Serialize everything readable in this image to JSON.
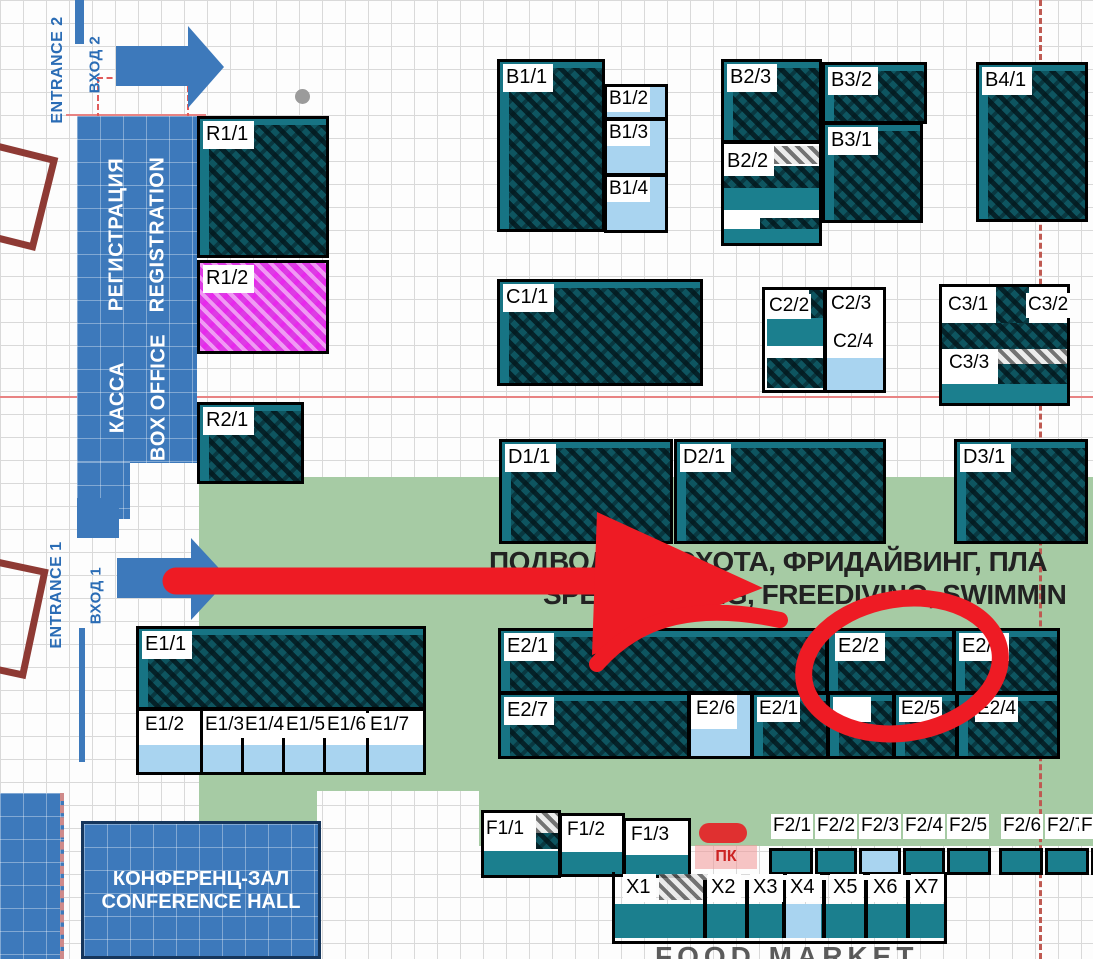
{
  "map": {
    "entrance2": {
      "en": "ENTRANCE 2",
      "ru": "ВХОД 2"
    },
    "entrance1": {
      "en": "ENTRANCE 1",
      "ru": "ВХОД 1"
    },
    "registration": {
      "ru": "РЕГИСТРАЦИЯ",
      "en": "REGISTRATION"
    },
    "box_office": {
      "ru": "КАССА",
      "en": "BOX OFFICE"
    },
    "conference": {
      "ru": "КОНФЕРЕНЦ-ЗАЛ",
      "en": "CONFERENCE HALL"
    },
    "zone_banner": {
      "ru": "ПОДВОДНАЯ ОХОТА, ФРИДАЙВИНГ, ПЛА",
      "en": "SPEARFISHING, FREEDIVING, SWIMMIN"
    },
    "food_market": "FOOD MARKET",
    "pk": "ПК"
  },
  "booths": {
    "r1_1": "R1/1",
    "r1_2": "R1/2",
    "r2_1": "R2/1",
    "b1_1": "B1/1",
    "b1_2": "B1/2",
    "b1_3": "B1/3",
    "b1_4": "B1/4",
    "b2_3": "B2/3",
    "b2_2": "B2/2",
    "b3_2": "B3/2",
    "b3_1": "B3/1",
    "b4_1": "B4/1",
    "c1_1": "C1/1",
    "c2_2": "C2/2",
    "c2_3": "C2/3",
    "c2_4": "C2/4",
    "c3_1": "C3/1",
    "c3_2": "C3/2",
    "c3_3": "C3/3",
    "d1_1": "D1/1",
    "d2_1": "D2/1",
    "d3_1": "D3/1",
    "e1_1": "E1/1",
    "e1_2": "E1/2",
    "e1_3": "E1/3",
    "e1_4": "E1/4",
    "e1_5": "E1/5",
    "e1_6": "E1/6",
    "e1_7": "E1/7",
    "e2_1t": "E2/1",
    "e2_2": "E2/2",
    "e2_3": "E2/3",
    "e2_7": "E2/7",
    "e2_6": "E2/6",
    "e2_1b": "E2/1",
    "e2_hidden": "",
    "e2_5": "E2/5",
    "e2_4": "E2/4",
    "f1_1": "F1/1",
    "f1_2": "F1/2",
    "f1_3": "F1/3",
    "f2_1": "F2/1",
    "f2_2": "F2/2",
    "f2_3": "F2/3",
    "f2_4": "F2/4",
    "f2_5": "F2/5",
    "f2_6": "F2/6",
    "f2_7": "F2/7",
    "f2_8": "F2/8",
    "x1": "X1",
    "x2": "X2",
    "x3": "X3",
    "x4": "X4",
    "x5": "X5",
    "x6": "X6",
    "x7": "X7"
  },
  "colors": {
    "booth_teal": "#0e5560",
    "booth_teal_solid": "#1b7f8e",
    "booth_lightblue": "#a9d4f0",
    "booth_magenta": "#dd3be4",
    "zone_green": "#a6cba4",
    "accent_blue": "#3d79bb",
    "annotation_red": "#ee1b24"
  }
}
